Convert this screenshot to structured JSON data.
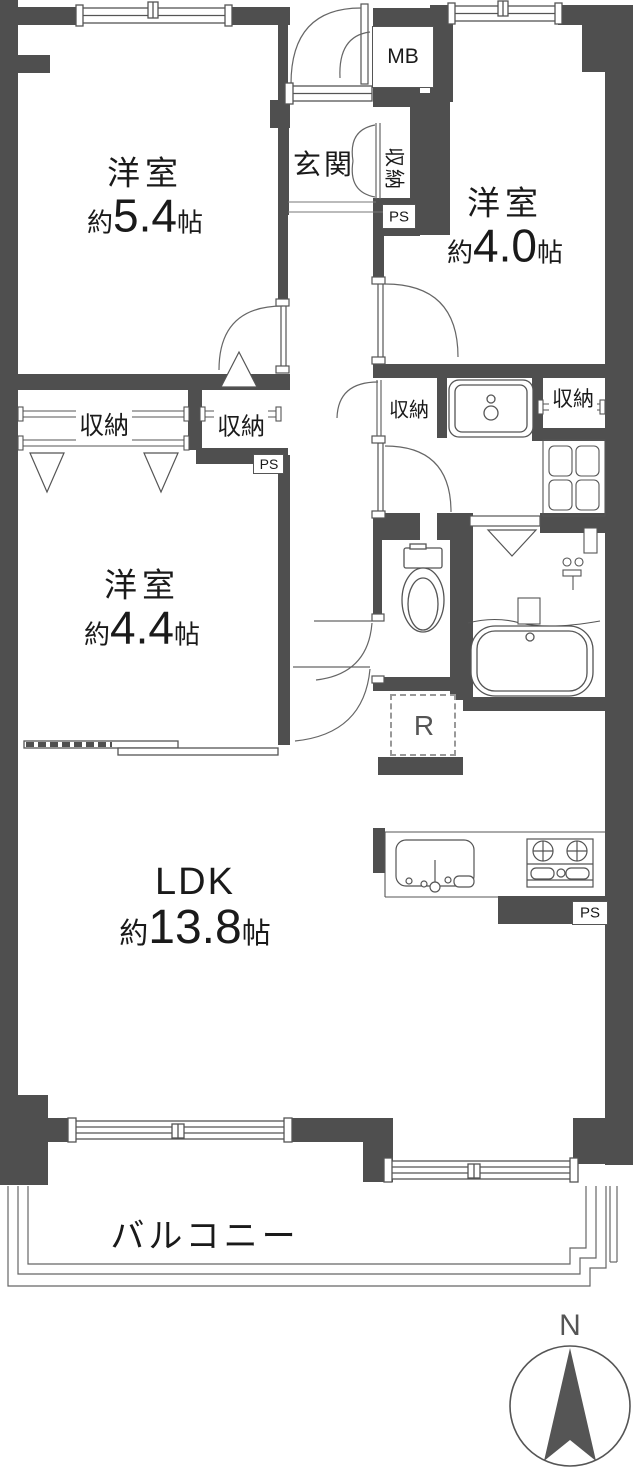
{
  "rooms": {
    "bedroom1": {
      "name": "洋室",
      "approx": "約",
      "value": "5.4",
      "unit": "帖"
    },
    "bedroom2": {
      "name": "洋室",
      "approx": "約",
      "value": "4.0",
      "unit": "帖"
    },
    "bedroom3": {
      "name": "洋室",
      "approx": "約",
      "value": "4.4",
      "unit": "帖"
    },
    "ldk": {
      "name": "LDK",
      "approx": "約",
      "value": "13.8",
      "unit": "帖"
    },
    "entrance": {
      "name": "玄関"
    },
    "balcony": {
      "name": "バルコニー"
    }
  },
  "labels": {
    "closet": "収納",
    "meter_box": "MB",
    "pipe_space": "PS",
    "refrigerator": "R",
    "north": "N"
  },
  "colors": {
    "wall": "#4f4f4f",
    "line": "#555555",
    "background": "#ffffff"
  }
}
